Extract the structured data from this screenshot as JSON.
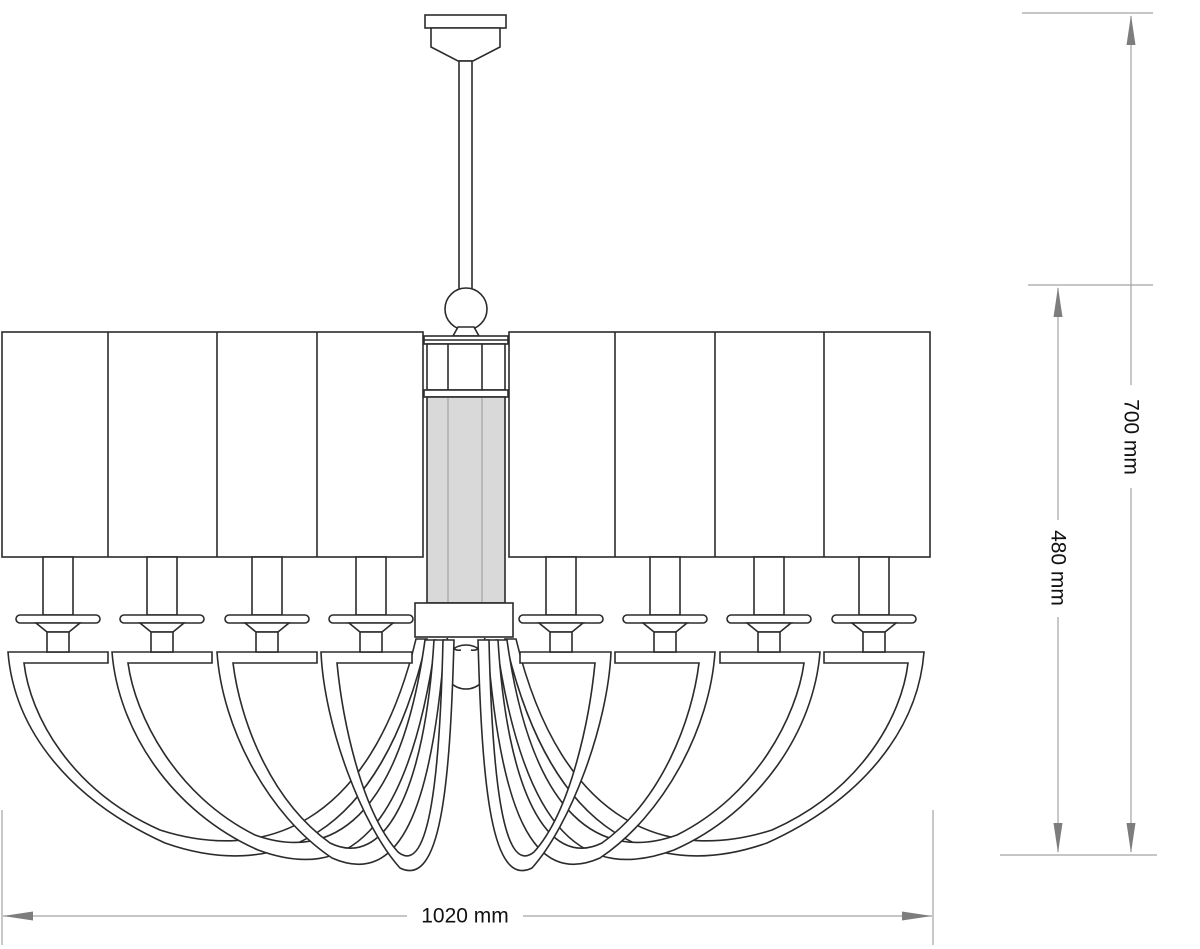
{
  "title": "Chandelier technical line drawing, front elevation",
  "dimensions": {
    "width": {
      "label": "1020 mm",
      "value": 1020,
      "unit": "mm",
      "orientation": "horizontal"
    },
    "overall_height": {
      "label": "700 mm",
      "value": 700,
      "unit": "mm",
      "orientation": "vertical"
    },
    "body_height": {
      "label": "480 mm",
      "value": 480,
      "unit": "mm",
      "orientation": "vertical"
    }
  },
  "components": {
    "canopy": "ceiling canopy",
    "rod": "suspension rod",
    "finial": "sphere finial",
    "column": "central glass column",
    "hub": "arm hub block",
    "ball": "bottom sphere",
    "shade_count": 8,
    "arm_count": 8,
    "candle_count": 8
  },
  "colors": {
    "outline": "#2b2b2b",
    "dimension_line": "#a3a3a3",
    "arrow": "#7d7d7d",
    "label_text": "#111111",
    "column_fill": "#d9d9d9",
    "background": "#ffffff"
  }
}
